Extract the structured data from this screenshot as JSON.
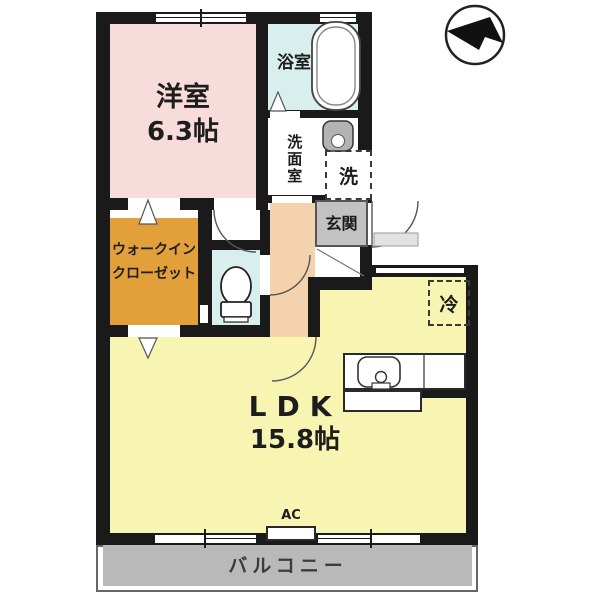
{
  "plan": {
    "type": "apartment-floorplan",
    "rooms": {
      "western": {
        "name": "洋室",
        "size": "6.3帖"
      },
      "bath": {
        "name": "浴室"
      },
      "washroom": {
        "name": "洗面室"
      },
      "washer": {
        "label": "洗"
      },
      "entrance": {
        "name": "玄関"
      },
      "wic": {
        "line1": "ウォークイン",
        "line2": "クローゼット"
      },
      "fridge": {
        "label": "冷"
      },
      "ldk": {
        "name": "LDK",
        "size": "15.8帖"
      },
      "ac": {
        "label": "AC"
      },
      "balcony": {
        "name": "バルコニー"
      }
    },
    "icons": [
      "north-arrow-icon",
      "bathtub-icon",
      "washbasin-icon",
      "toilet-icon",
      "kitchen-sink-icon",
      "door-arc"
    ]
  },
  "colors": {
    "western": "#f8dcdc",
    "bath": "#d8efed",
    "toilet": "#d8efed",
    "wic": "#e2a03a",
    "corridor": "#f4d2ae",
    "ldk": "#f8f4b2",
    "genkan": "#c2c2c2",
    "balcony": "#b9b9b9",
    "wall": "#1a1a1a"
  }
}
